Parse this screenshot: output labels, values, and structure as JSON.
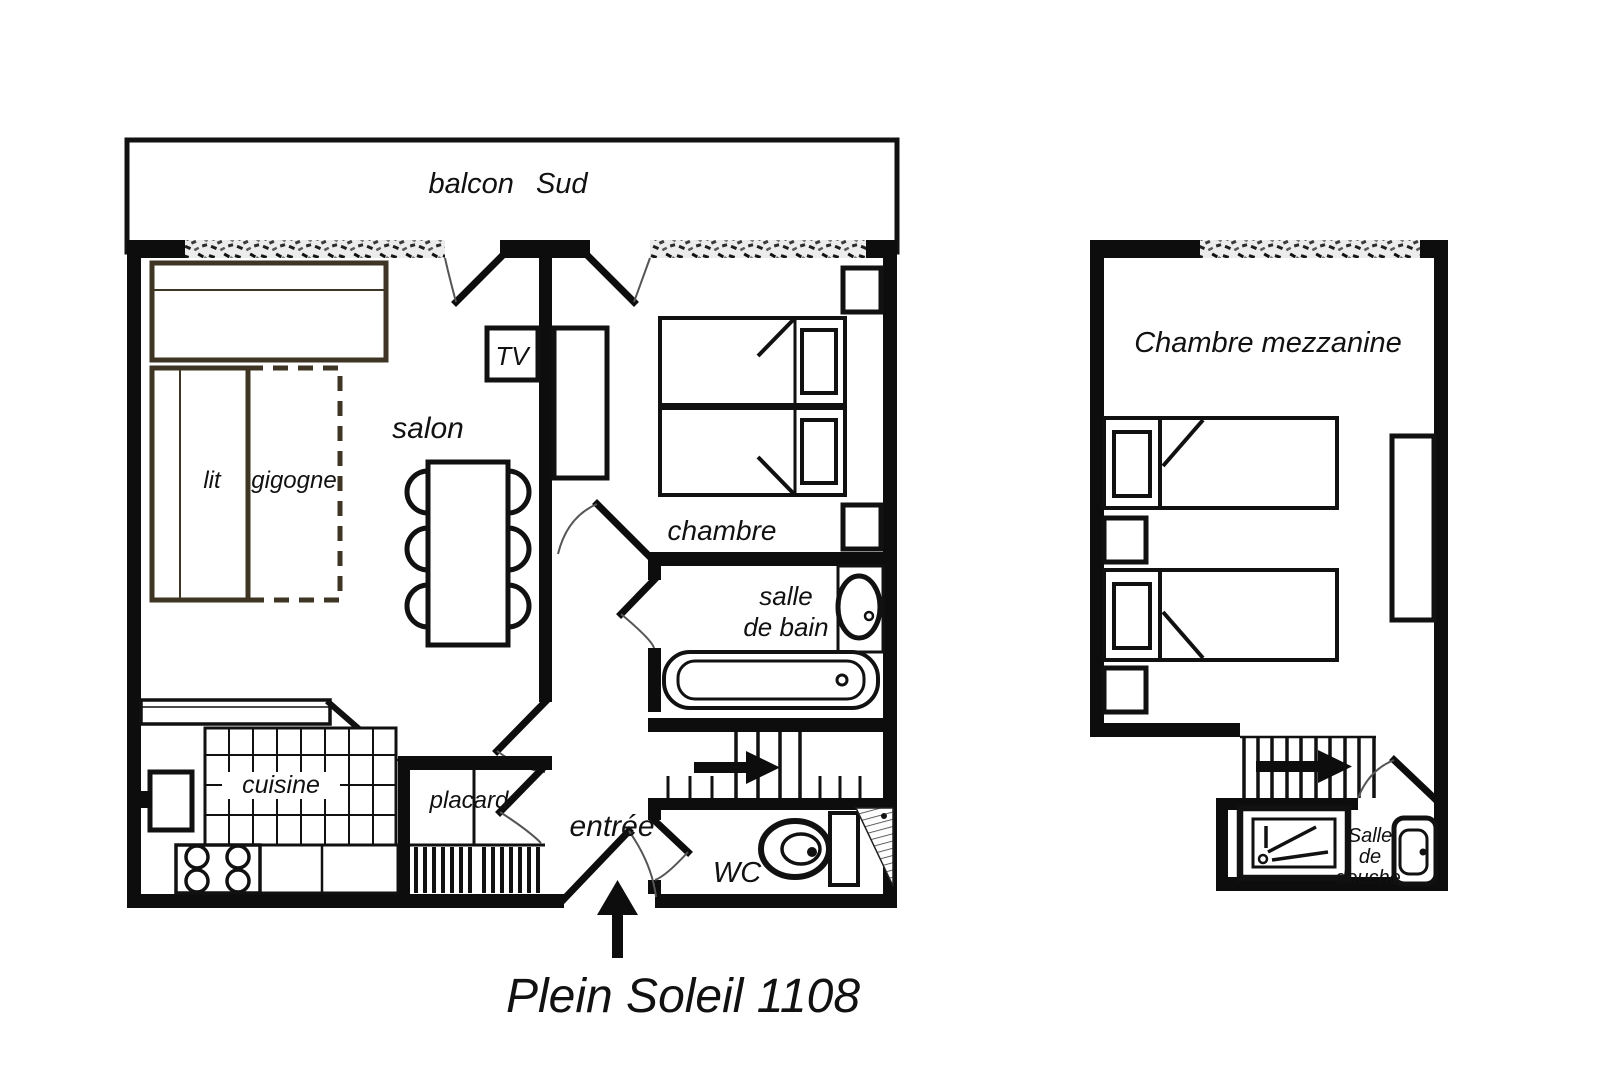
{
  "title": "Plein Soleil 1108",
  "colors": {
    "ink": "#111111",
    "wood_outline": "#3e3524"
  },
  "main_floor": {
    "balcony_label": "balcon Sud",
    "living_room_label": "salon",
    "tv_label": "TV",
    "trundle_bed": {
      "lit": "lit",
      "gigogne": "gigogne"
    },
    "bedroom_label": "chambre",
    "bathroom": {
      "line1": "salle",
      "line2": "de bain"
    },
    "kitchen_label": "cuisine",
    "closet_label": "placard",
    "entrance_label": "entrée",
    "wc_label": "WC"
  },
  "mezzanine": {
    "bedroom_label": "Chambre mezzanine",
    "shower_room": {
      "line1": "Salle",
      "line2": "de",
      "line3": "douche"
    }
  }
}
